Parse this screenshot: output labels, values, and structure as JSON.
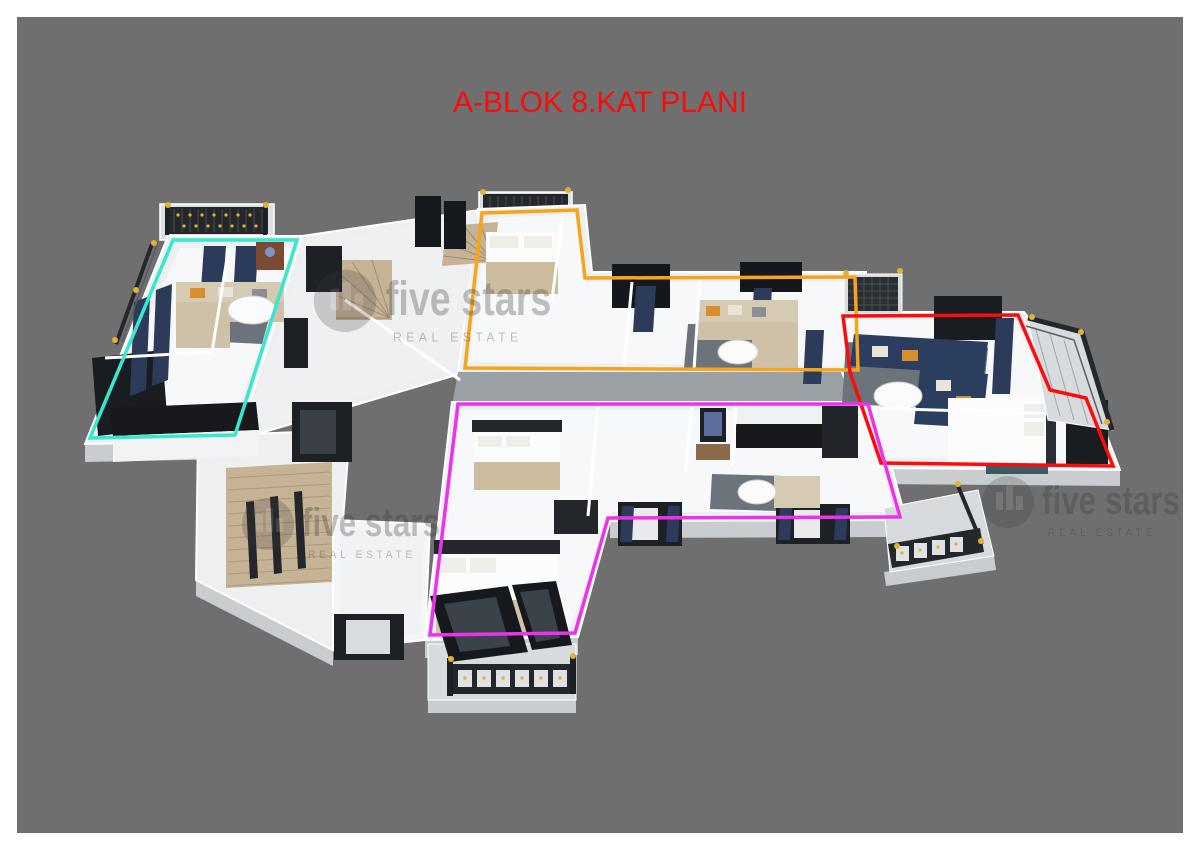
{
  "title": {
    "text": "A-BLOK 8.KAT PLANI",
    "color": "#fb0b0b"
  },
  "canvas": {
    "background": "#6f6f6f",
    "border": "#ffffff"
  },
  "watermark": {
    "line1": "five stars",
    "line2": "REAL ESTATE",
    "color": "#3a3a3a",
    "opacity": 0.3,
    "instances": [
      {
        "x": 345,
        "y": 296,
        "scale": 1.2
      },
      {
        "x": 268,
        "y": 520,
        "scale": 1.0
      },
      {
        "x": 1008,
        "y": 498,
        "scale": 1.0
      }
    ]
  },
  "units": [
    {
      "name": "unit-top-left",
      "color": "#38e7cf",
      "stroke_width": 3.5,
      "points": "173,240 297,240 235,435 90,438"
    },
    {
      "name": "unit-top-middle",
      "color": "#f7a41d",
      "stroke_width": 3.5,
      "points": "482,213 577,210 585,278 855,277 858,370 465,368"
    },
    {
      "name": "unit-right",
      "color": "#fb0d0d",
      "stroke_width": 3.5,
      "points": "843,316 1018,315 1050,390 1086,398 1113,466 881,463 850,372"
    },
    {
      "name": "unit-bottom-middle",
      "color": "#ea33ea",
      "stroke_width": 3.5,
      "points": "458,404 868,404 900,517 608,518 575,633 430,635"
    }
  ],
  "palette": {
    "gold_accent": "#e3b230",
    "navy": "#2c3b59",
    "dark_frame": "#1d2126",
    "beige": "#d7cab2",
    "slab": "#edeff0"
  }
}
